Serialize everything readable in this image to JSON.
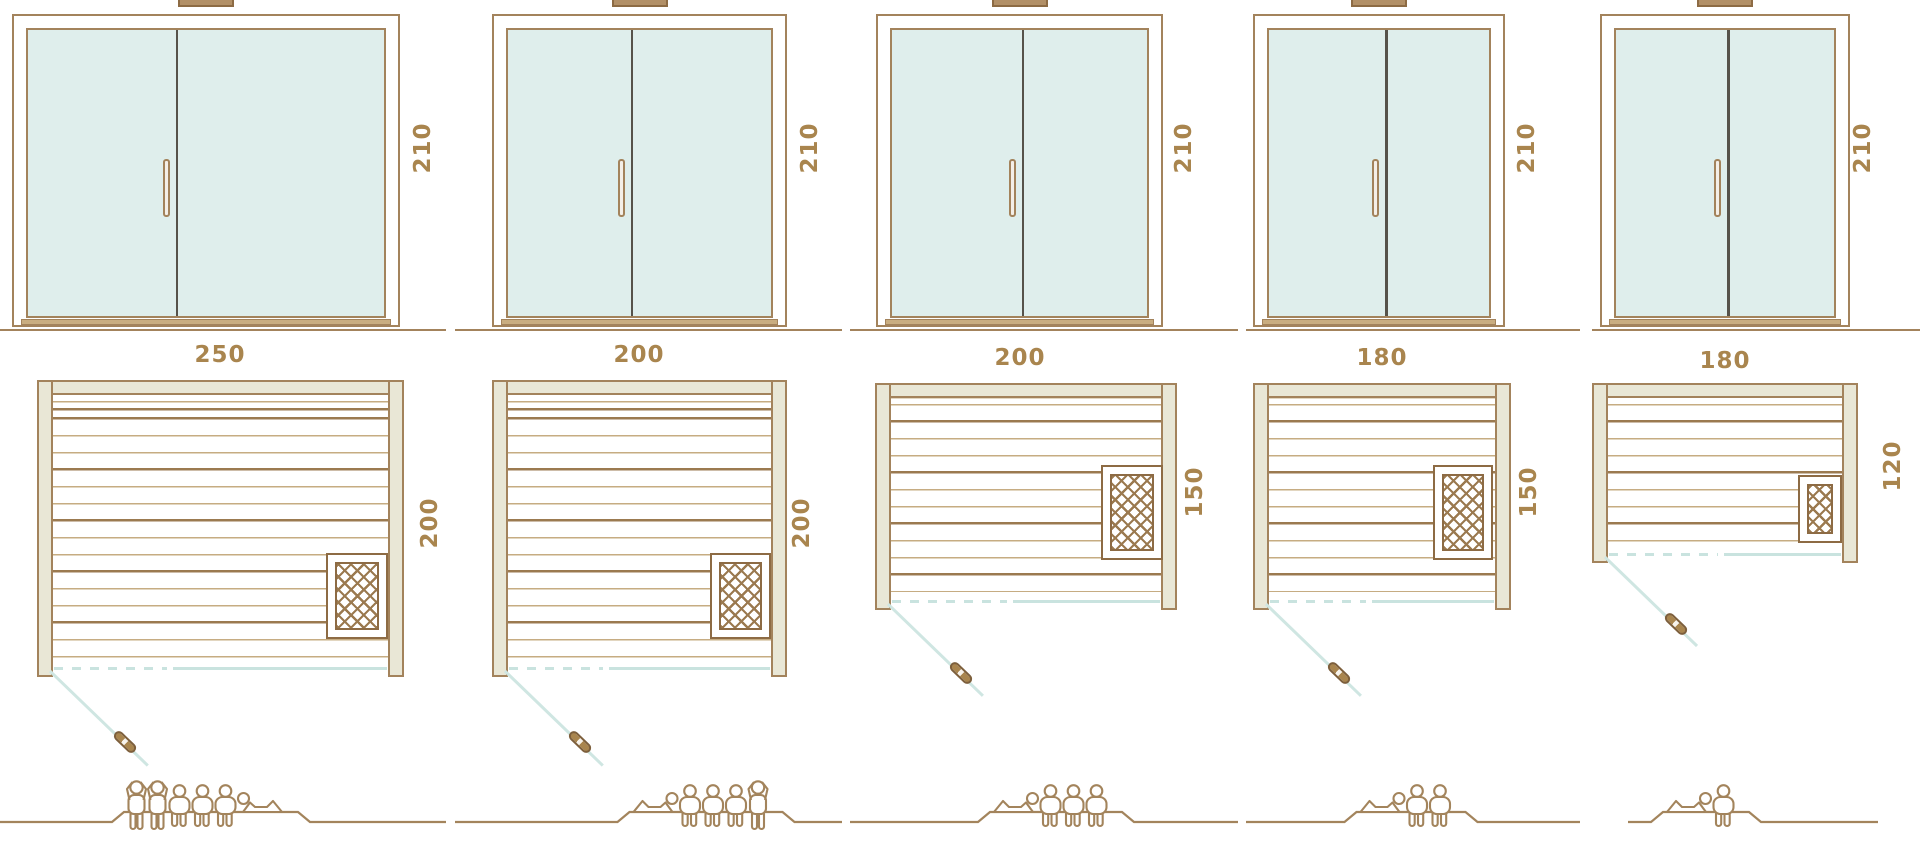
{
  "diagram": {
    "type": "sauna size comparison drawing",
    "rows": [
      "door elevation",
      "floor plan",
      "capacity figures"
    ]
  },
  "colors": {
    "line_tan": "#a3835c",
    "line_brown": "#8d6b44",
    "plank_thin": "#c6ac82",
    "plank_thick": "#9b7a50",
    "wall_beige_fill": "#e9e7d6",
    "glass_fill": "#dfeeec",
    "door_divider": "#56524a",
    "glass_teal_line": "#c9e3df",
    "label_text": "#a9854e",
    "vent_fill": "#b29067",
    "people_outline": "#a3845c"
  },
  "icons": {
    "heater": "heater-crosshatch-icon",
    "door_swing": "door-swing-line",
    "door_swing_handle": "door-swing-handle-icon",
    "person_standing": "person-standing-icon",
    "person_sitting": "person-sitting-icon",
    "person_lying": "person-lying-icon"
  },
  "models": [
    {
      "elevation": {
        "height_label": "210"
      },
      "plan": {
        "width_label": "250",
        "depth_label": "200"
      },
      "capacity": {
        "total": 6,
        "standing": 2,
        "sitting": 3,
        "lying": 1,
        "figures": [
          "standing",
          "standing",
          "sitting",
          "sitting",
          "sitting",
          "lying-right"
        ]
      }
    },
    {
      "elevation": {
        "height_label": "210"
      },
      "plan": {
        "width_label": "200",
        "depth_label": "200"
      },
      "capacity": {
        "total": 5,
        "standing": 1,
        "sitting": 3,
        "lying": 1,
        "figures": [
          "lying-left",
          "sitting",
          "sitting",
          "sitting",
          "standing"
        ]
      }
    },
    {
      "elevation": {
        "height_label": "210"
      },
      "plan": {
        "width_label": "200",
        "depth_label": "150"
      },
      "capacity": {
        "total": 4,
        "standing": 0,
        "sitting": 3,
        "lying": 1,
        "figures": [
          "lying-left",
          "sitting",
          "sitting",
          "sitting"
        ]
      }
    },
    {
      "elevation": {
        "height_label": "210"
      },
      "plan": {
        "width_label": "180",
        "depth_label": "150"
      },
      "capacity": {
        "total": 3,
        "standing": 0,
        "sitting": 2,
        "lying": 1,
        "figures": [
          "lying-left",
          "sitting",
          "sitting"
        ]
      }
    },
    {
      "elevation": {
        "height_label": "210"
      },
      "plan": {
        "width_label": "180",
        "depth_label": "120"
      },
      "capacity": {
        "total": 2,
        "standing": 0,
        "sitting": 1,
        "lying": 1,
        "figures": [
          "lying-left",
          "sitting"
        ]
      }
    }
  ]
}
